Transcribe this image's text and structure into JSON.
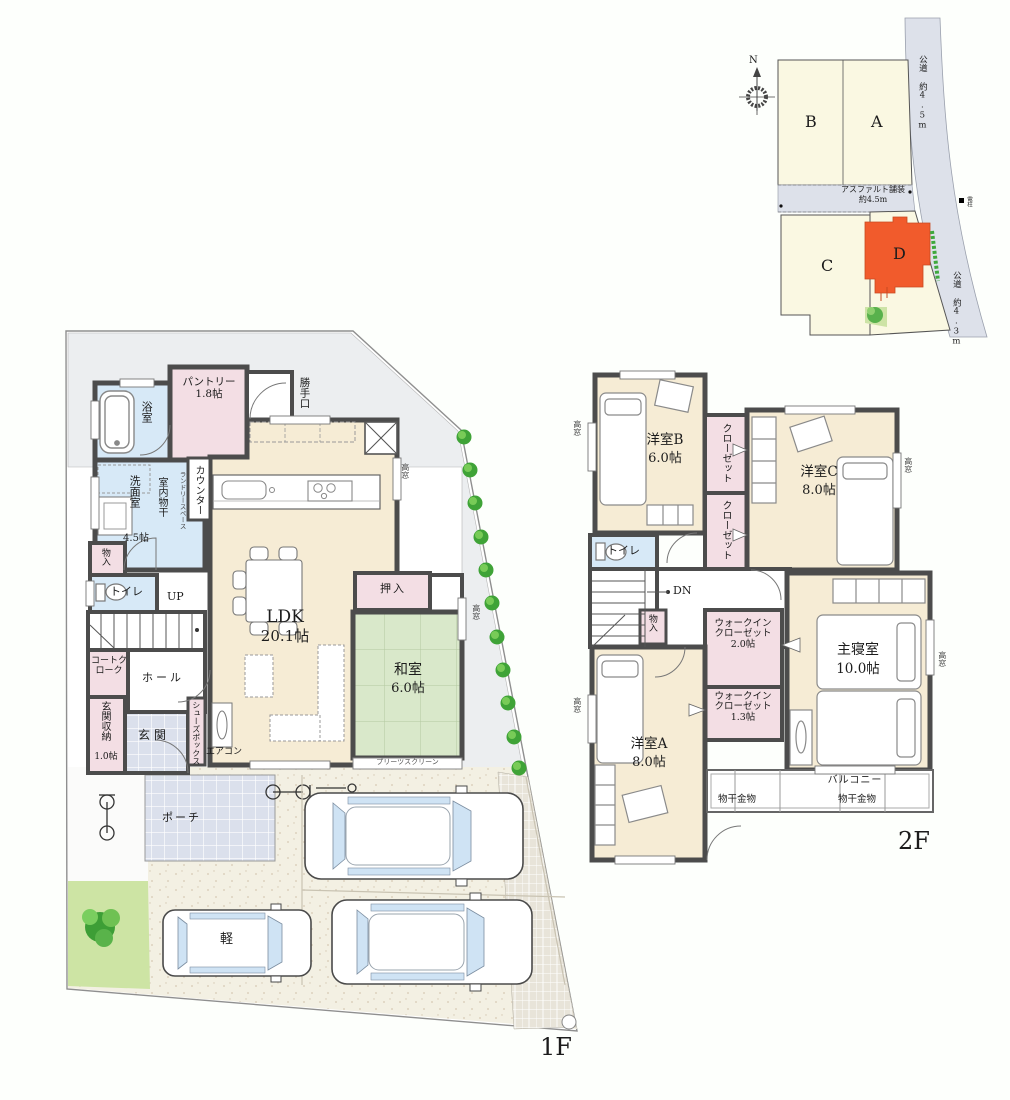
{
  "site_plan": {
    "north": "N",
    "lot_a": "A",
    "lot_b": "B",
    "lot_c": "C",
    "lot_d": "D",
    "road_right_top": "公道 約4.5m",
    "road_right_bottom": "公道 約4.3m",
    "road_surface": "アスファルト舗装",
    "road_width": "約4.5m",
    "pole": "電柱"
  },
  "floor1": {
    "floor_label": "1F",
    "bath": "浴室",
    "pantry_name": "パントリー",
    "pantry_size": "1.8帖",
    "back_door": "勝手口",
    "washroom_name": "洗面室",
    "washroom_size": "4.5帖",
    "indoor_drying": "室内物干",
    "counter": "カウンター",
    "laundry_space": "ランドリースペース",
    "storage": "物入",
    "toilet": "トイレ",
    "up": "UP",
    "coat_closet": "コートクローク",
    "hall": "ホール",
    "entrance_storage_name": "玄関収納",
    "entrance_storage_size": "1.0帖",
    "entrance": "玄関",
    "shoe_box": "シューズボックス",
    "aircon": "エアコン",
    "ldk_name": "LDK",
    "ldk_size": "20.1帖",
    "oshiire": "押入",
    "washitsu_name": "和室",
    "washitsu_size": "6.0帖",
    "pleats_screen": "プリーツスクリーン",
    "porch": "ポーチ",
    "kei_car": "軽",
    "high_window": "高窓"
  },
  "floor2": {
    "floor_label": "2F",
    "room_b_name": "洋室B",
    "room_b_size": "6.0帖",
    "room_c_name": "洋室C",
    "room_c_size": "8.0帖",
    "room_a_name": "洋室A",
    "room_a_size": "8.0帖",
    "master_name": "主寝室",
    "master_size": "10.0帖",
    "closet": "クローゼット",
    "toilet": "トイレ",
    "dn": "DN",
    "storage": "物入",
    "wic_name": "ウォークインクローゼット",
    "wic1_size": "2.0帖",
    "wic2_size": "1.3帖",
    "balcony": "バルコニー",
    "hanger": "物干金物",
    "high_window": "高窓"
  }
}
